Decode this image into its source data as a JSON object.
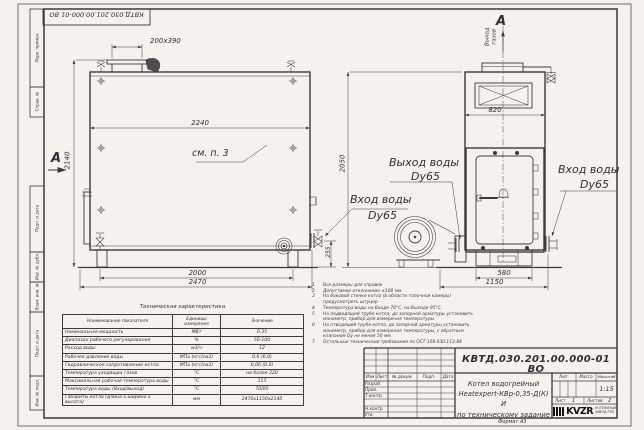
{
  "stamp_top": {
    "text": "КВТД.030.201.00.000-01 ВО"
  },
  "margin_labels": [
    "Перв. примен.",
    "Справ. №",
    "Подп. и дата",
    "Инв. № дубл.",
    "Взам. инв. №",
    "Подп. и дата",
    "Инв. № подл."
  ],
  "front_view": {
    "section_label": "А",
    "see_ref": "см. п. 3",
    "dim_chimney": "200х390",
    "dim_width": "2240",
    "dim_height": "2140",
    "dim_frame": "2000",
    "dim_overall": "2470",
    "dim_outlet": "255",
    "inlet_line1": "Вход воды",
    "inlet_line2": "Dy65"
  },
  "side_view": {
    "section_label": "А",
    "gas_line1": "Выход",
    "gas_line2": "газов",
    "dim_top": "820",
    "dim_base": "580",
    "dim_depth": "1150",
    "dim_height": "2050",
    "outlet_line1": "Выход воды",
    "outlet_line2": "Dy65",
    "inlet_line1": "Вход воды",
    "inlet_line2": "Dy65"
  },
  "notes": [
    {
      "num": "1",
      "text": "Все размеры для справок"
    },
    {
      "num": "2",
      "text": "Допустимое отклонение ±100 мм."
    },
    {
      "num": "3",
      "text": "На боковой стенке котла (в области топочной камеры) предусмотреть штуцер"
    },
    {
      "num": "4",
      "text": "Температура воды на Входе 70°С, на Выходе 95°С."
    },
    {
      "num": "5",
      "text": "На подводящей трубе котла, до запорной арматуры установить манометр, прибор для измерения температуры"
    },
    {
      "num": "6",
      "text": "На отводящей трубе котла, до запорной арматуры установить манометр, прибор для измерения температуры, с обратным клапаном Dу не менее 50 мм."
    },
    {
      "num": "7",
      "text": "Остальные технические требования по ОСТ 108.030.113-84"
    }
  ],
  "tech_table": {
    "title": "Техническая характеристика",
    "col_name": "Наименование показателя",
    "col_units": "Единицы измерения",
    "col_value": "Значение",
    "rows": [
      {
        "name": "Номинальная мощность",
        "units": "МВт",
        "value": "0,35"
      },
      {
        "name": "Диапазон рабочего регулирования",
        "units": "%",
        "value": "50-100"
      },
      {
        "name": "Расход воды",
        "units": "м3/ч",
        "value": "12"
      },
      {
        "name": "Рабочее давление воды",
        "units": "МПа (кгс/см2)",
        "value": "0,6 (6,0)"
      },
      {
        "name": "Гидравлическое сопротивление котла",
        "units": "МПа (кгс/см2)",
        "value": "0,06 (0,6)"
      },
      {
        "name": "Температура уходящих газов",
        "units": "°С",
        "value": "не более 220"
      },
      {
        "name": "Максимальная рабочая температура воды",
        "units": "°С",
        "value": "115"
      },
      {
        "name": "Температура воды (Вход/выход)",
        "units": "°С",
        "value": "70/95"
      },
      {
        "name": "Габариты котла (длина х ширина х высота)",
        "units": "мм",
        "value": "2470х1150х2140"
      }
    ]
  },
  "title_block": {
    "doc_number": "КВТД.030.201.00.000-01 ВО",
    "name_line1": "Котел водогрейный",
    "name_line2": "Heatexpert-КВр-0,35-Д(К) И",
    "name_line3": "по техническому задание",
    "h_izm": "Изм",
    "h_list": "Лист",
    "h_doc": "№ докум.",
    "h_sign": "Подп.",
    "h_date": "Дата",
    "r_razrab": "Разраб.",
    "r_prov": "Пров.",
    "r_tkontr": "Т.контр.",
    "r_nkontr": "Н.контр.",
    "r_utv": "Утв.",
    "h_lit": "Лит.",
    "h_mass": "Масса",
    "h_scale": "Масштаб",
    "scale_value": "1:15",
    "sheet_label": "Лист",
    "sheet_value": "1",
    "sheets_label": "Листов",
    "sheets_value": "2",
    "logo_text": "KVZR",
    "company_line1": "КОТЕЛЬНЫЙ",
    "company_line2": "ЗАВОД РЭП",
    "format_note": "Формат А3"
  }
}
